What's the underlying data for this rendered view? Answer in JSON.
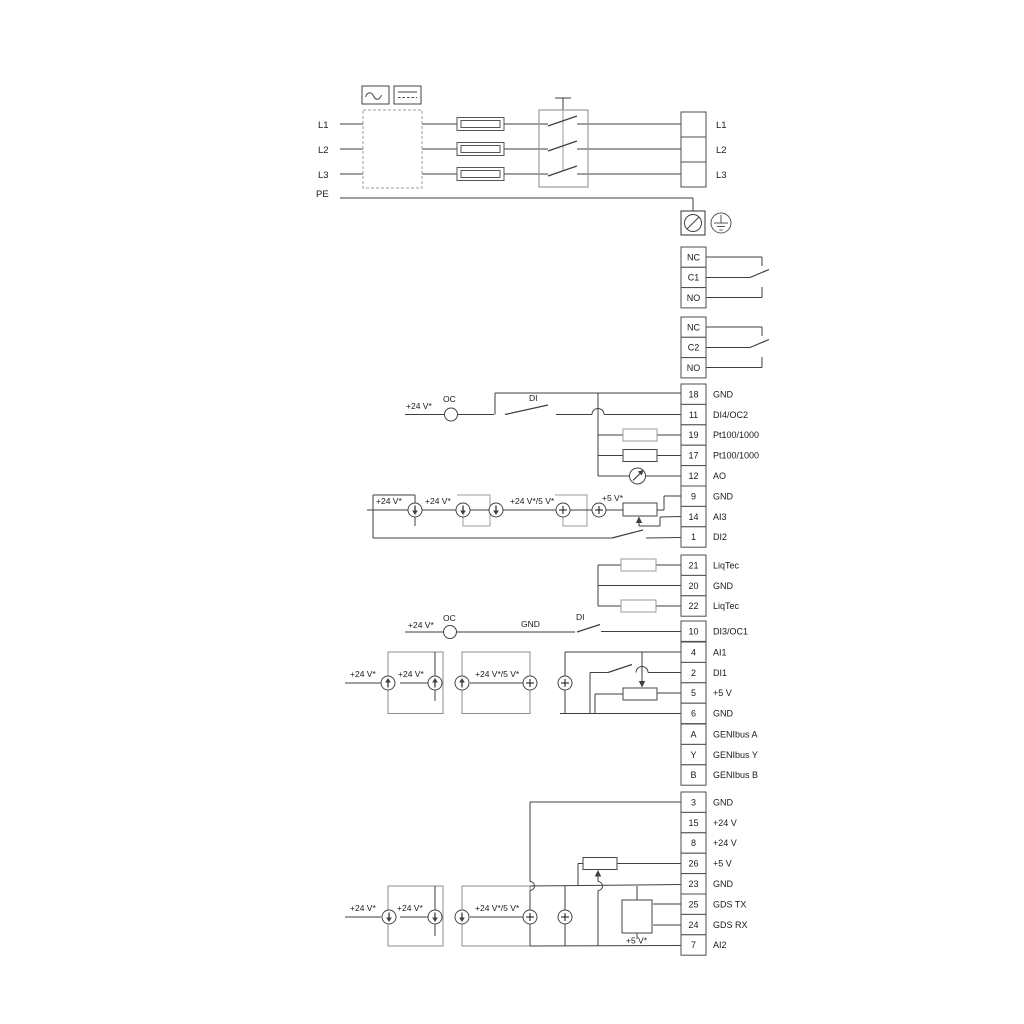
{
  "colors": {
    "wire": "#3f3f3f",
    "wire_light": "#9b9b9b",
    "box_gray": "#8c8c8c",
    "text": "#1a1a1a",
    "background": "#ffffff"
  },
  "power": {
    "input_labels": [
      "L1",
      "L2",
      "L3",
      "PE"
    ],
    "output_labels": [
      "L1",
      "L2",
      "L3"
    ]
  },
  "relays": [
    {
      "cells": [
        "NC",
        "C1",
        "NO"
      ]
    },
    {
      "cells": [
        "NC",
        "C2",
        "NO"
      ]
    }
  ],
  "terminal_groups": {
    "io1": [
      [
        "18",
        "GND"
      ],
      [
        "11",
        "DI4/OC2"
      ],
      [
        "19",
        "Pt100/1000"
      ],
      [
        "17",
        "Pt100/1000"
      ],
      [
        "12",
        "AO"
      ],
      [
        "9",
        "GND"
      ],
      [
        "14",
        "AI3"
      ],
      [
        "1",
        "DI2"
      ]
    ],
    "liqtec": [
      [
        "21",
        "LiqTec"
      ],
      [
        "20",
        "GND"
      ],
      [
        "22",
        "LiqTec"
      ]
    ],
    "di3": [
      [
        "10",
        "DI3/OC1"
      ]
    ],
    "ai1": [
      [
        "4",
        "AI1"
      ],
      [
        "2",
        "DI1"
      ],
      [
        "5",
        "+5 V"
      ],
      [
        "6",
        "GND"
      ]
    ],
    "genibus": [
      [
        "A",
        "GENIbus A"
      ],
      [
        "Y",
        "GENIbus Y"
      ],
      [
        "B",
        "GENIbus B"
      ]
    ],
    "bottom": [
      [
        "3",
        "GND"
      ],
      [
        "15",
        "+24 V"
      ],
      [
        "8",
        "+24 V"
      ],
      [
        "26",
        "+5 V"
      ],
      [
        "23",
        "GND"
      ],
      [
        "25",
        "GDS TX"
      ],
      [
        "24",
        "GDS RX"
      ],
      [
        "7",
        "AI2"
      ]
    ]
  },
  "annotations": {
    "v24": "+24 V*",
    "v24_5": "+24 V*/5 V*",
    "v5": "+5 V*",
    "oc": "OC",
    "di": "DI",
    "gnd": "GND"
  }
}
